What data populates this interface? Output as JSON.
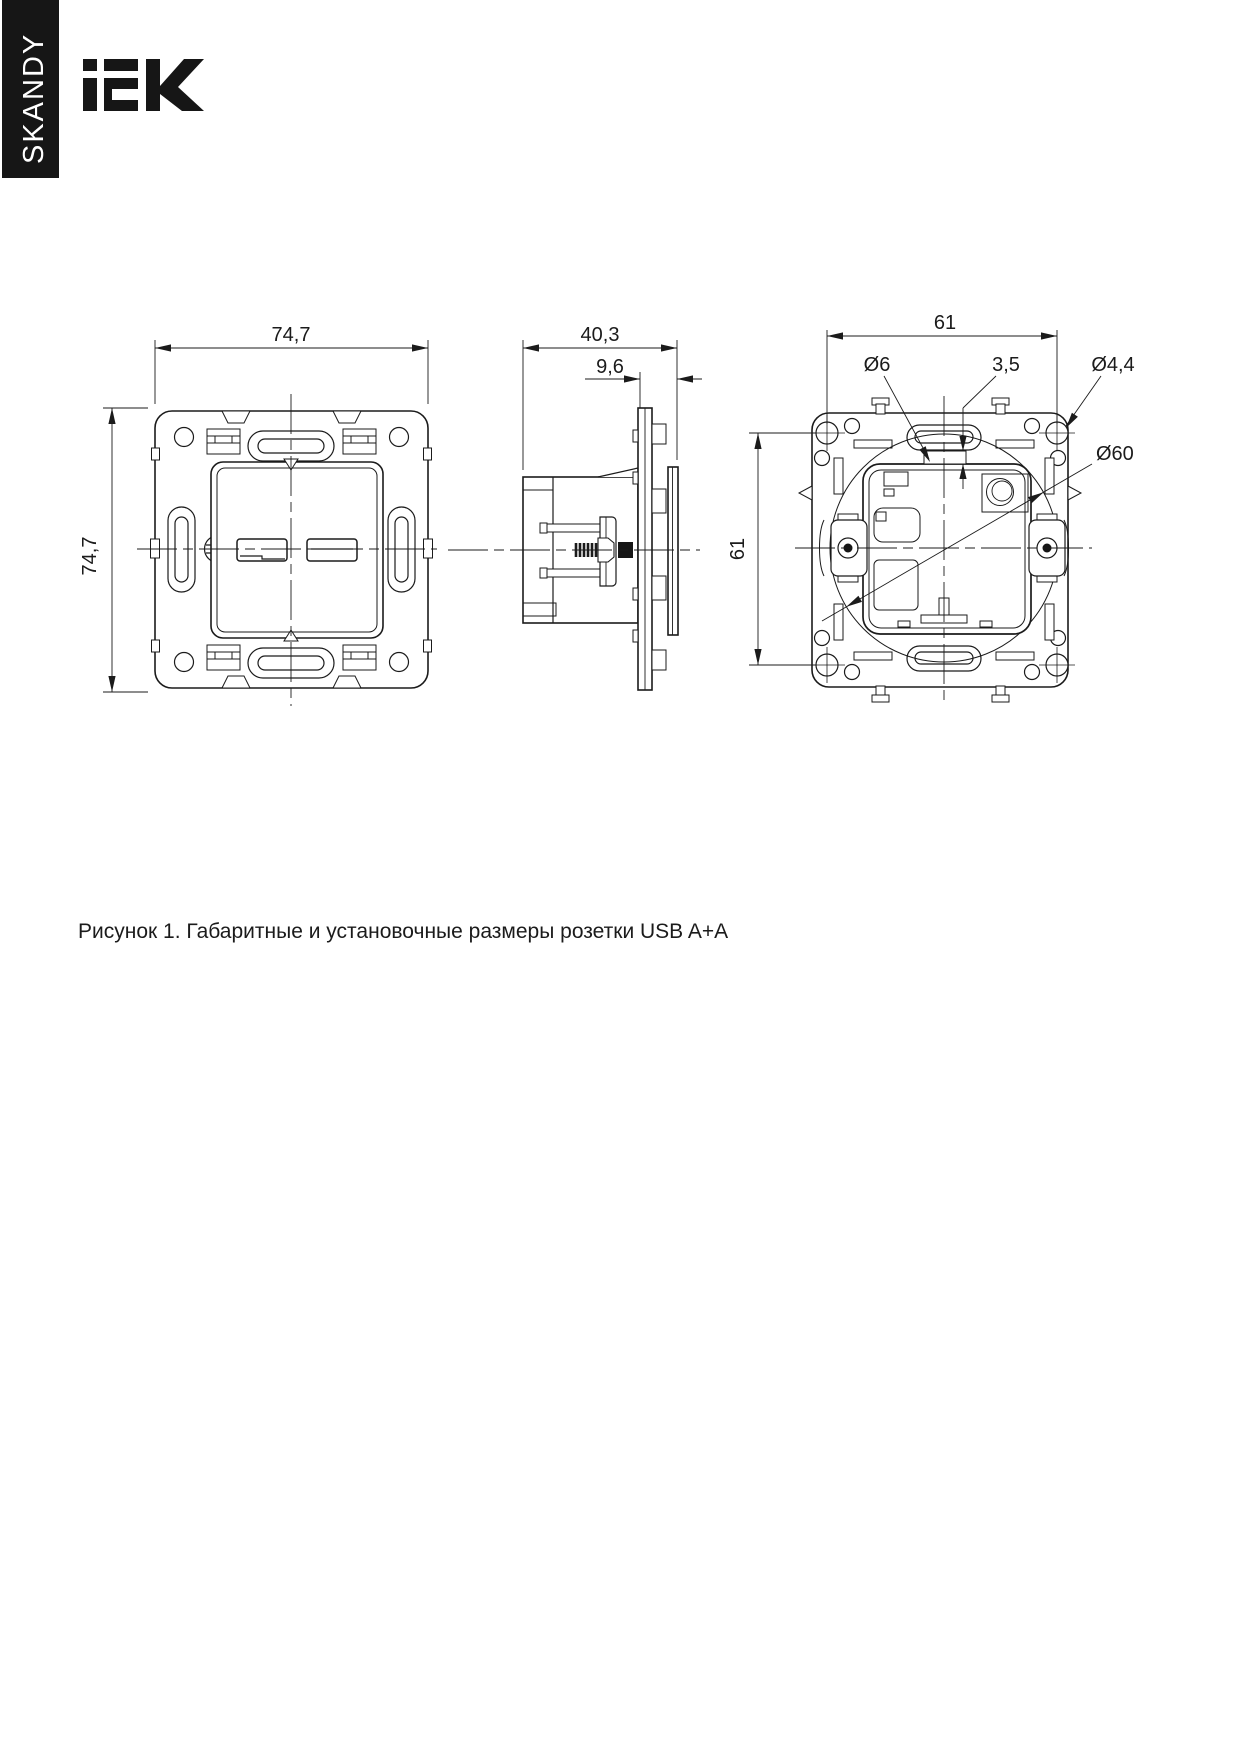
{
  "header": {
    "series_banner": "SKANDY",
    "brand_logo": "IEK"
  },
  "figure": {
    "caption": "Рисунок 1. Габаритные и установочные размеры розетки USB A+A"
  },
  "views": {
    "front": {
      "dim_width": "74,7",
      "dim_height": "74,7"
    },
    "side": {
      "dim_depth": "40,3",
      "dim_front_depth": "9,6"
    },
    "back": {
      "dim_width": "61",
      "dim_height": "61",
      "dim_hole": "Ø6",
      "dim_tab": "3,5",
      "dim_screw_hole": "Ø4,4",
      "dim_mount_circle": "Ø60"
    }
  },
  "icons": {
    "logo": "iek-logo",
    "banner": "series-banner"
  },
  "colors": {
    "line": "#1b1b1b",
    "banner_bg": "#161616",
    "banner_text": "#ffffff"
  }
}
